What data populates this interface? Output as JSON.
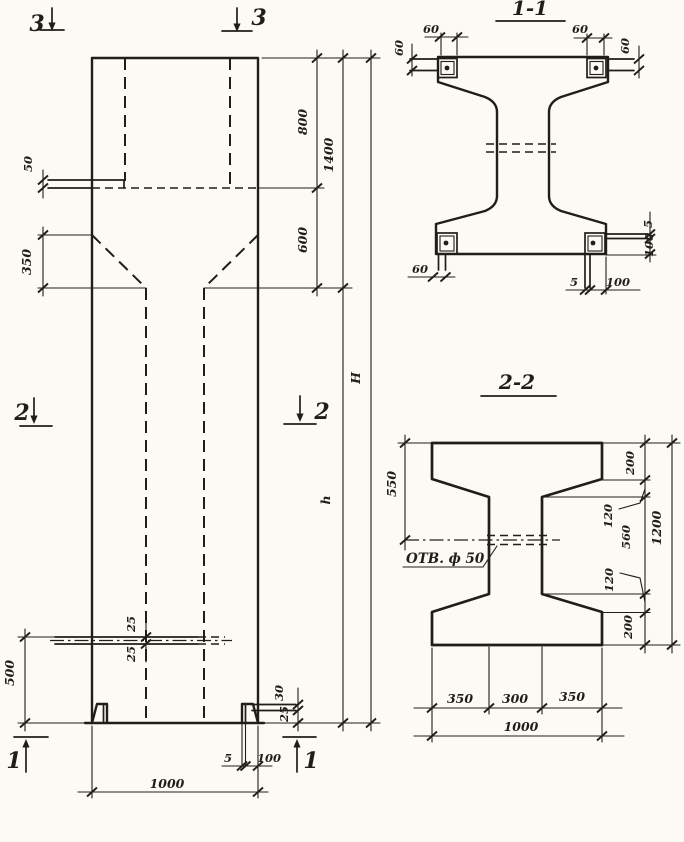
{
  "palette": {
    "paper": "#fbfaf5",
    "ink": "#211d17"
  },
  "elevation": {
    "marks": {
      "top_left": "3",
      "top_right": "3",
      "mid_left": "2",
      "mid_right": "2",
      "bottom_left": "1",
      "bottom_right": "1"
    },
    "dims": {
      "d50": "50",
      "d350": "350",
      "d800": "800",
      "d600": "600",
      "d1400": "1400",
      "dH": "H",
      "dh": "h",
      "d25_upper": "25",
      "d25_lower": "25",
      "d500": "500",
      "d30": "30",
      "d25_foot": "25",
      "d5_plate": "5",
      "d100_plate": "100",
      "d1000": "1000"
    }
  },
  "section11": {
    "title": "1-1",
    "dims": {
      "d60_left_rot": "60",
      "d60_left_top": "60",
      "d60_right_top": "60",
      "d60_right_rot": "60",
      "d60_bottom": "60",
      "d5_side": "5",
      "d100_side": "100",
      "d5_bottom": "5",
      "d100_bottom": "100"
    }
  },
  "section22": {
    "title": "2-2",
    "hole_label": "ОТВ. ф 50",
    "dims": {
      "d550": "550",
      "d200_top": "200",
      "d120_top": "120",
      "d560": "560",
      "d120_bottom": "120",
      "d200_bottom": "200",
      "d1200": "1200",
      "d350_left": "350",
      "d300": "300",
      "d350_right": "350",
      "d1000": "1000"
    }
  }
}
